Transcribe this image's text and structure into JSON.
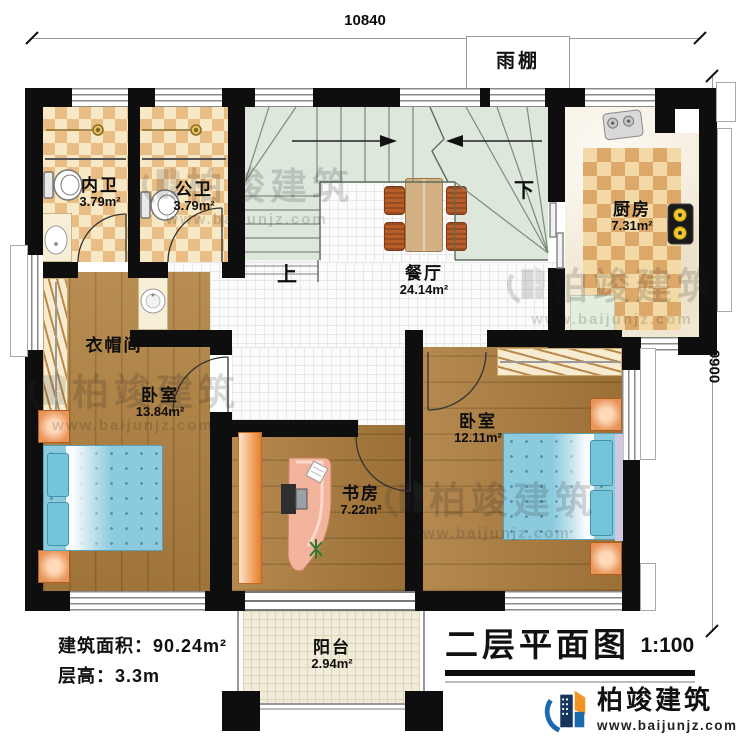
{
  "dimensions": {
    "top": "10840",
    "right": "9900"
  },
  "canopy": "雨棚",
  "stairs": {
    "up": "上",
    "down": "下"
  },
  "rooms": {
    "bath1": {
      "name": "内卫",
      "area": "3.79m²"
    },
    "bath2": {
      "name": "公卫",
      "area": "3.79m²"
    },
    "kitchen": {
      "name": "厨房",
      "area": "7.31m²"
    },
    "dining": {
      "name": "餐厅",
      "area": "24.14m²"
    },
    "cloakroom": {
      "name": "衣帽间"
    },
    "bedroom_left": {
      "name": "卧室",
      "area": "13.84m²"
    },
    "bedroom_right": {
      "name": "卧室",
      "area": "12.11m²"
    },
    "study": {
      "name": "书房",
      "area": "7.22m²"
    },
    "balcony": {
      "name": "阳台",
      "area": "2.94m²"
    }
  },
  "info": {
    "building_area": "建筑面积：90.24m²",
    "floor_height": "层高：3.3m"
  },
  "title": {
    "text": "二层平面图",
    "scale": "1:100"
  },
  "brand": {
    "name": "柏竣建筑",
    "url": "www.baijunjz.com"
  },
  "watermark": {
    "name": "柏竣建筑",
    "url": "www.baijunjz.com"
  },
  "colors": {
    "wall": "#0e0e0e",
    "stair": "#dde7dc",
    "wood": "#b1813f",
    "bathroom_check": "#e9bd83",
    "bed": "#8ccade",
    "furniture_orange": "#e8955a",
    "logo_blue": "#1b6ab0",
    "logo_orange": "#f39324"
  }
}
